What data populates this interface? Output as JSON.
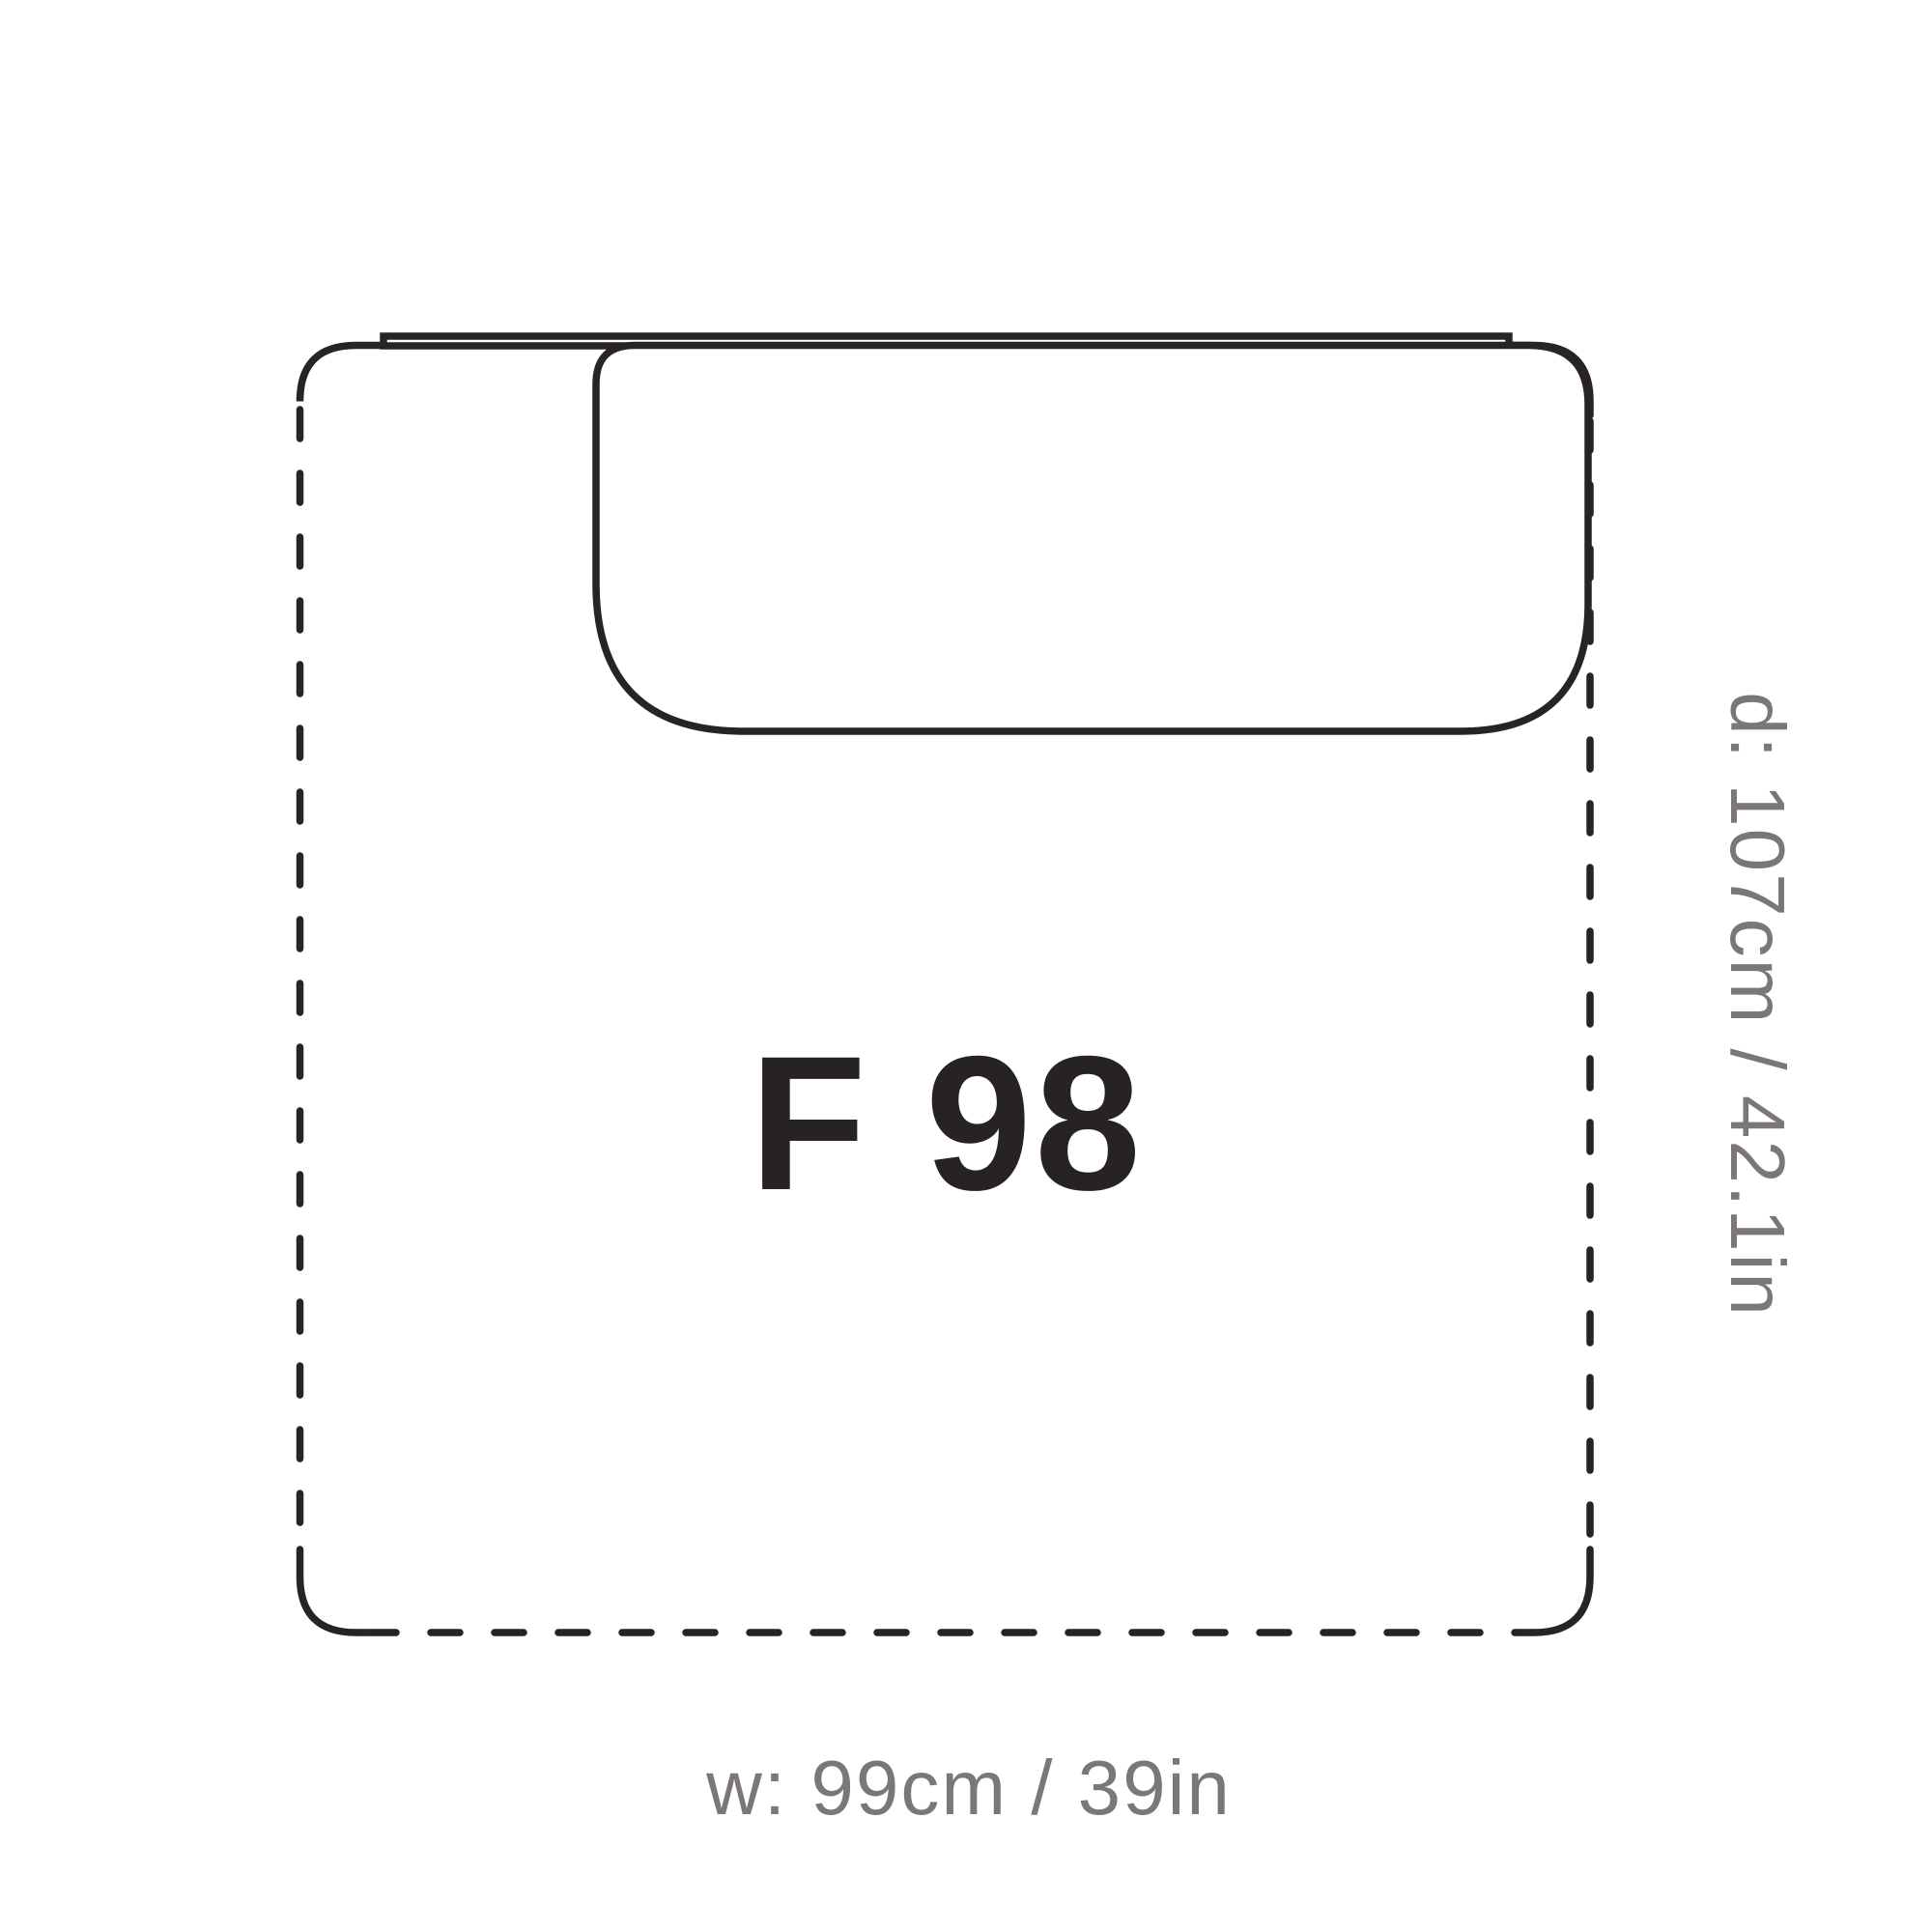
{
  "diagram": {
    "module_label": "F 98",
    "width_label": "w: 99cm / 39in",
    "depth_label": "d: 107cm / 42.1in"
  },
  "colors": {
    "line": "#282425",
    "label_text": "#272324",
    "dim_text": "#7b7777",
    "background": "#ffffff"
  }
}
